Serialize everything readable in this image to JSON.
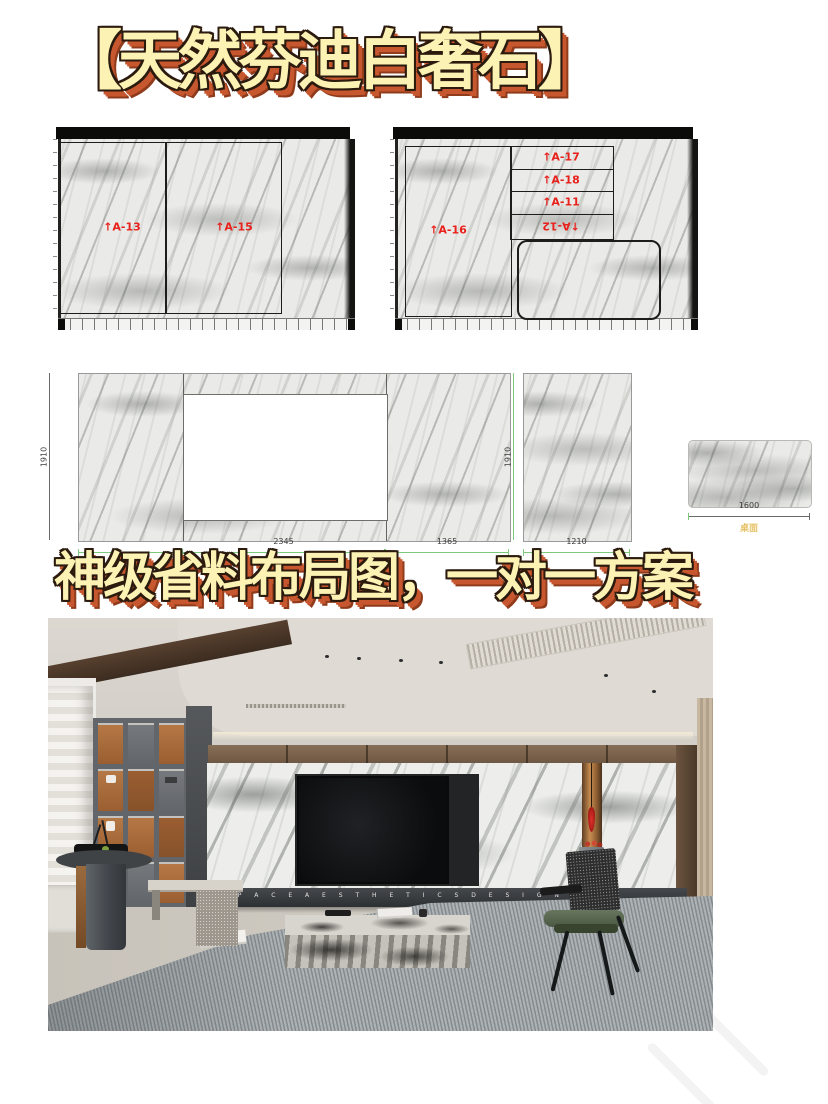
{
  "title": {
    "text": "【天然芬迪白奢石】"
  },
  "subtitle": {
    "text": "神级省料布局图，一对一方案"
  },
  "colors": {
    "accent_red": "#E8211C",
    "dim_green": "#7CC97C",
    "banner_fill": "#FBF2B4",
    "banner_shadow": "#C7572E",
    "caption_gold": "#E6C368"
  },
  "slab_diagrams": {
    "left": {
      "pieces": [
        {
          "label": "↑A-13"
        },
        {
          "label": "↑A-15"
        }
      ]
    },
    "right": {
      "main_label": "↑A-16",
      "strip_labels": [
        "↑A-17",
        "↑A-18",
        "↑A-11",
        "↑A-12"
      ]
    }
  },
  "elevation": {
    "height_left": "1910",
    "height_right": "1910",
    "width_main": "2345",
    "width_right": "1365",
    "width_slab": "1210",
    "table": {
      "width": "1600",
      "caption": "桌面"
    }
  },
  "photo": {
    "console_text": "S P A C E   A E S T H E T I C S   D E S I G N"
  }
}
